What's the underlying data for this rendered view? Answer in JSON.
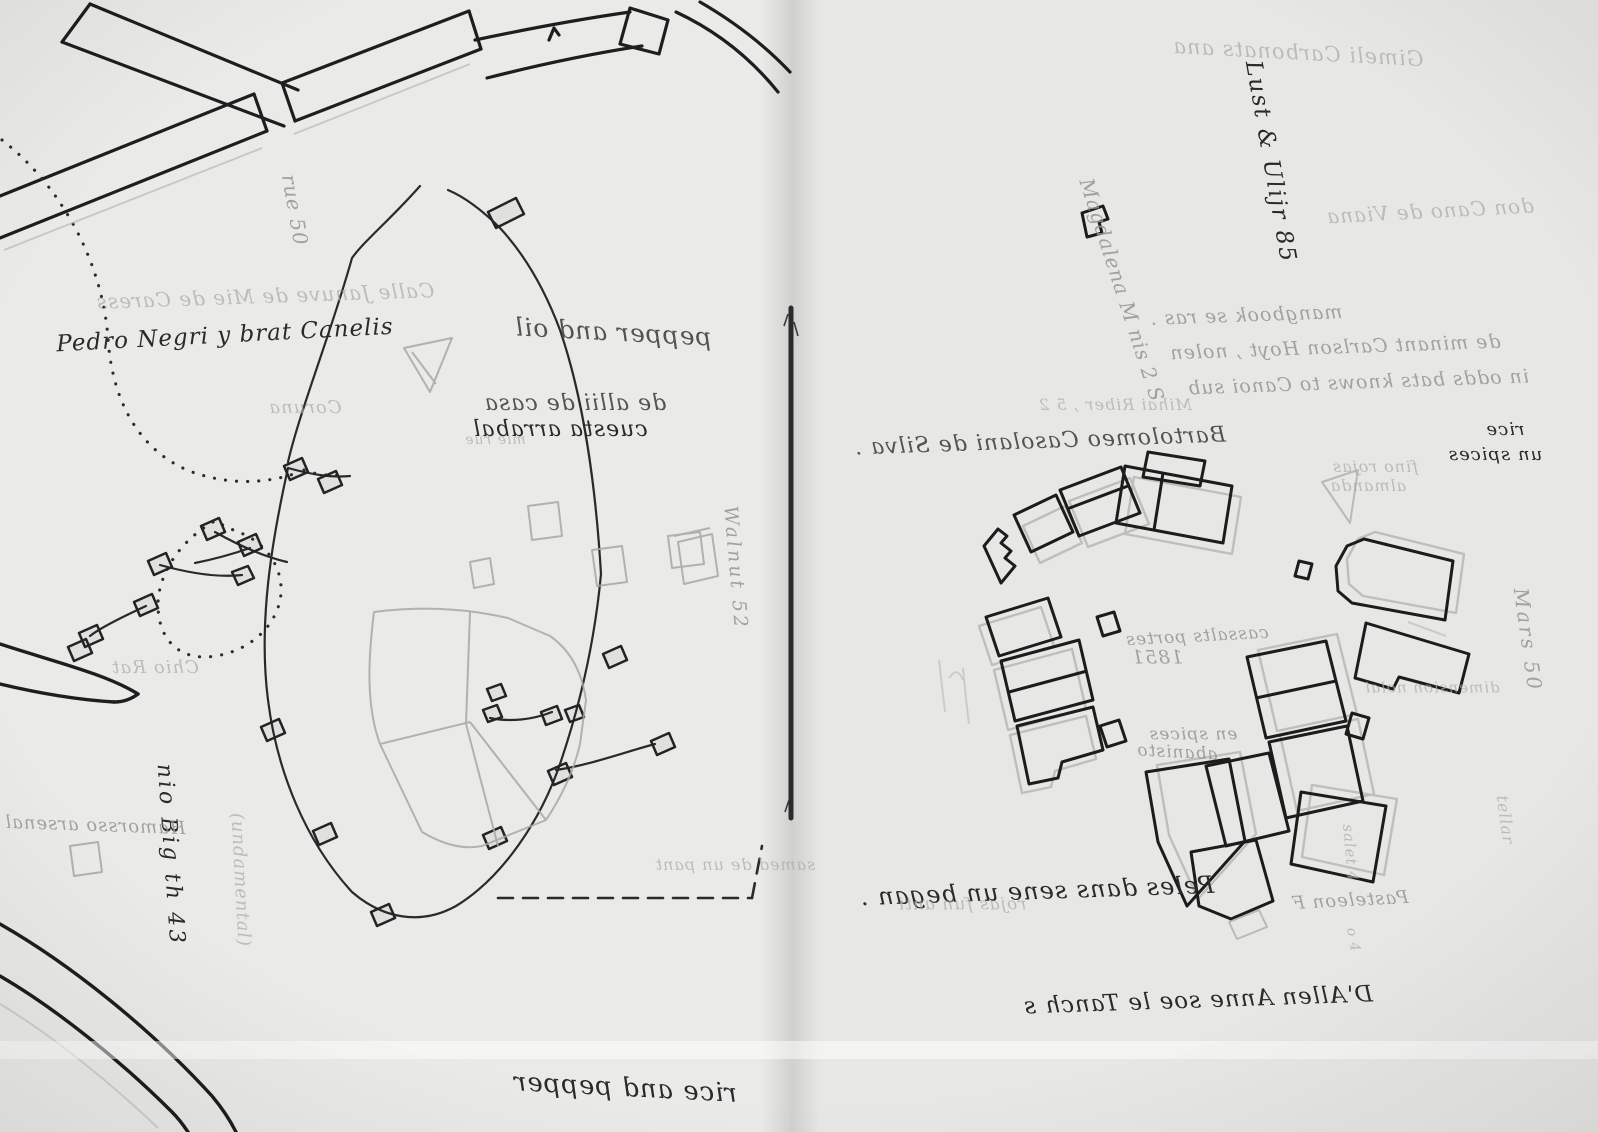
{
  "meta": {
    "description": "Hand-drawn field map on translucent tracing paper, two-page stitched spread; dark ink roads and building footprints with pencil ghosts and mirrored show-through handwriting",
    "paper_color": "#e9e9e7",
    "ink_color": "#1f1f1f",
    "pencil_color": "#a5a3a0",
    "binding_color": "#2b2b2b"
  },
  "left_page": {
    "labels": {
      "pedro_negri": "Pedro Negri y brat Canelis",
      "calle_ghost": "Calle Januve de Mie de Caress",
      "rue_50": "rue 50",
      "coruna": "Coruna",
      "pepper_and_oil": "pepper and oil",
      "allii_line1": "de allii de casa",
      "allii_line2": "cuesta arrabal",
      "mie_rue": "mie rue",
      "walnut_52": "Walnut  52",
      "chio_rat": "Chio Rat",
      "big_43": "nio Big th 43",
      "fundamental": "(undamental)",
      "hamorsso": "Hamorsso arsenal",
      "samed": "samed de un pant",
      "rice_and_pepper": "rice and pepper"
    }
  },
  "right_page": {
    "labels": {
      "gimeli": "Gimeli Carbonats ana",
      "lust_85": "Lust & Ulijr  85",
      "don_cano": "don Cano de Viana",
      "magdalena": "Magdalena M nis  2 S",
      "note_line1": "mangbook se ras .",
      "note_line2": "de minant Carlson Hoyt , nolen",
      "note_line3": "in odds bats knows to Canoi sub",
      "bartolomeo": "Bartolomeo Casolani de Silva .",
      "mihai": "Mihai Riber ,  5 2",
      "rice": "rice",
      "un_spices": "un spices",
      "fino_rojas": "fino rojas",
      "almanda": "almanda",
      "mars_50": "Mars 50",
      "dimension": "dimension nolai",
      "cassalts": "cassalts portes",
      "year_1851": "1851",
      "en_spices": "en spices",
      "abanisto": "abanisto",
      "peles": "Peles dans sene un began .",
      "rojas_fun": "rojas fun anti",
      "pasteleon": "Pasteleon F",
      "salet_4": "salet 4",
      "o_4": "o 4",
      "dallen": "D'Allen Anne soe le Tanch s",
      "tellar": "tellar"
    }
  }
}
